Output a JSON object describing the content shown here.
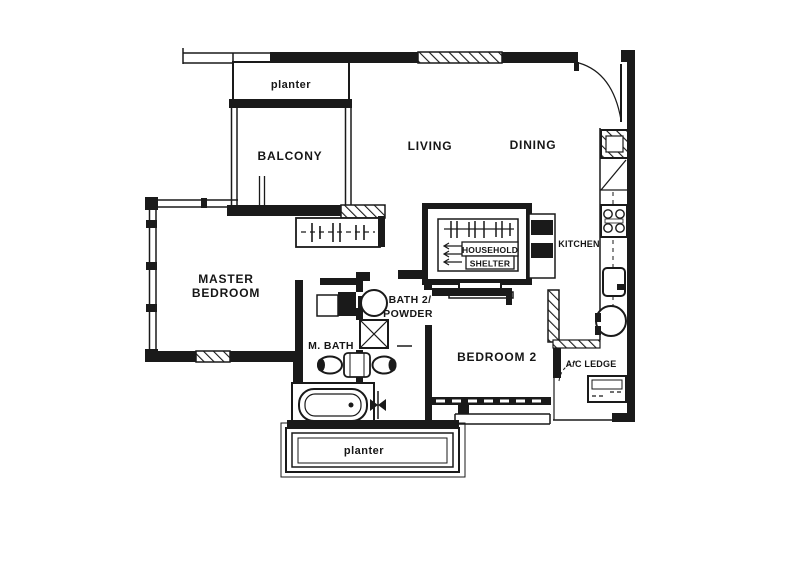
{
  "colors": {
    "line": "#1a1a1a",
    "background": "#ffffff"
  },
  "rooms": {
    "planter_top": {
      "label": "planter"
    },
    "balcony": {
      "label": "BALCONY"
    },
    "living": {
      "label": "LIVING"
    },
    "dining": {
      "label": "DINING"
    },
    "kitchen": {
      "label": "KITCHEN"
    },
    "household_shelter": {
      "line1": "HOUSEHOLD",
      "line2": "SHELTER"
    },
    "master_bedroom": {
      "line1": "MASTER",
      "line2": "BEDROOM"
    },
    "bath2_powder": {
      "line1": "BATH 2/",
      "line2": "POWDER"
    },
    "master_bath": {
      "label": "M. BATH"
    },
    "bedroom2": {
      "label": "BEDROOM 2"
    },
    "ac_ledge": {
      "label": "A/C LEDGE"
    },
    "planter_bottom": {
      "label": "planter"
    }
  }
}
